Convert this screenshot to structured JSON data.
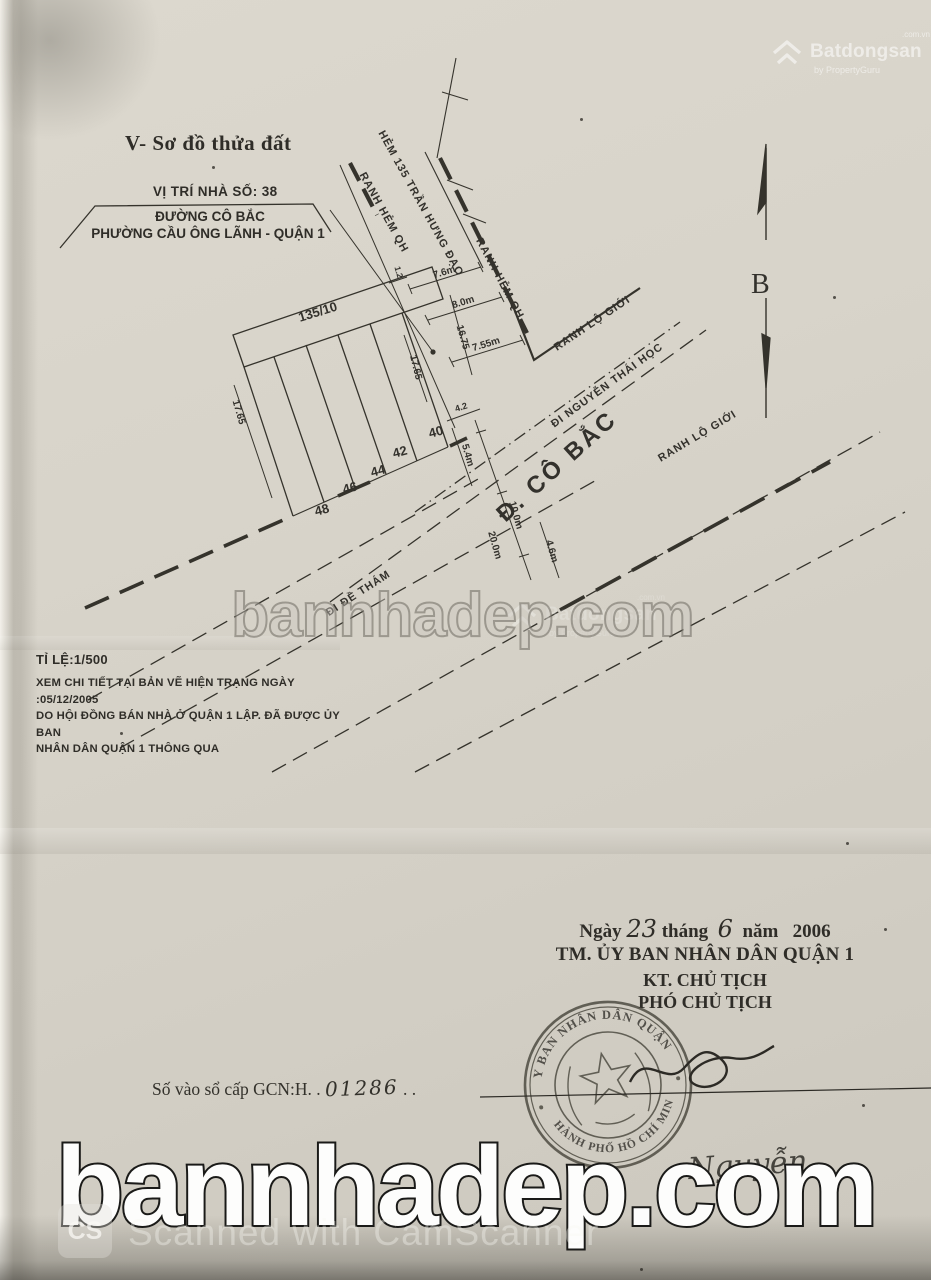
{
  "title": "V- Sơ đồ thửa đất",
  "location_box": {
    "line1": "VỊ TRÍ NHÀ SỐ: 38",
    "line2": "ĐƯỜNG CÔ BẮC",
    "line3": "PHƯỜNG CẦU ÔNG LÃNH - QUẬN 1"
  },
  "compass": {
    "label": "B"
  },
  "map": {
    "parcels": [
      "135/10",
      "40",
      "42",
      "44",
      "46",
      "48"
    ],
    "labels": [
      "HẺM 135 TRẦN HƯNG ĐẠO",
      "RANH HẺM QH",
      "RANH HẺM QH",
      "RANH LỘ GIỚI",
      "ĐI NGUYỄN THÁI HỌC",
      "Đ. CÔ BẮC",
      "RANH LỘ GIỚI",
      "ĐI ĐỀ THÁM"
    ],
    "dimensions": [
      "1.2",
      "7.6m",
      "8.0m",
      "16.75",
      "7.55m",
      "17.65",
      "17.65",
      "4.2",
      "5.4m",
      "10.0m",
      "20.0m",
      "4.6m"
    ]
  },
  "scale_note": {
    "scale": "TỈ LỆ:1/500",
    "line1": "XEM CHI TIẾT TẠI BẢN VẼ HIỆN TRẠNG NGÀY :05/12/2005",
    "line2": "DO HỘI ĐỒNG BÁN NHÀ Ở QUẬN 1 LẬP. ĐÃ ĐƯỢC ỦY BAN",
    "line3": "NHÂN DÂN QUẬN 1 THÔNG QUA"
  },
  "signature_block": {
    "date_prefix": "Ngày",
    "day": "23",
    "month_label": "tháng",
    "month": "6",
    "year_label": "năm",
    "year": "2006",
    "authority": "TM. ỦY BAN NHÂN DÂN QUẬN 1",
    "deputy_for": "KT. CHỦ TỊCH",
    "deputy_title": "PHÓ CHỦ TỊCH",
    "signer_name": "Nguyễn"
  },
  "registry": {
    "label": "Số vào sổ cấp GCN:H. .",
    "number": "01286",
    "trailing": ". ."
  },
  "stamp": {
    "arc_top": "ỦY BAN NHÂN DÂN QUẬN 1",
    "arc_bottom": "THÀNH PHỐ HỒ CHÍ MINH"
  },
  "watermarks": {
    "brand_center": "bannhadep.com",
    "brand_bottom": "bannhadep.com",
    "batdongsan_name": "Batdongsan",
    "batdongsan_sup": ".com.vn",
    "batdongsan_sub": "by PropertyGuru",
    "camscanner_icon": "CS",
    "camscanner_label": "Scanned with CamScanner"
  }
}
